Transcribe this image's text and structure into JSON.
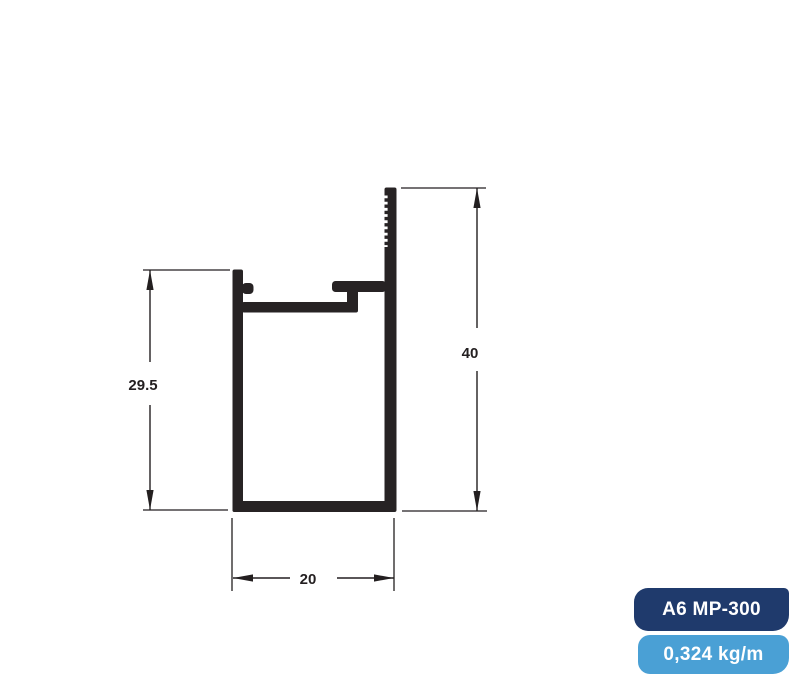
{
  "drawing": {
    "type": "aluminium-profile-cross-section",
    "line_color": "#231f20",
    "profile_fill_color": "#272324",
    "background_color": "#ffffff",
    "dimensions": {
      "height_left": {
        "value": "29.5"
      },
      "height_right": {
        "value": "40"
      },
      "width_bottom": {
        "value": "20"
      }
    }
  },
  "badges": {
    "model": {
      "label": "A6 MP-300",
      "bg_color": "#1f3a6c",
      "text_color": "#ffffff"
    },
    "weight": {
      "label": "0,324 kg/m",
      "bg_color": "#4aa0d5",
      "text_color": "#ffffff"
    }
  }
}
